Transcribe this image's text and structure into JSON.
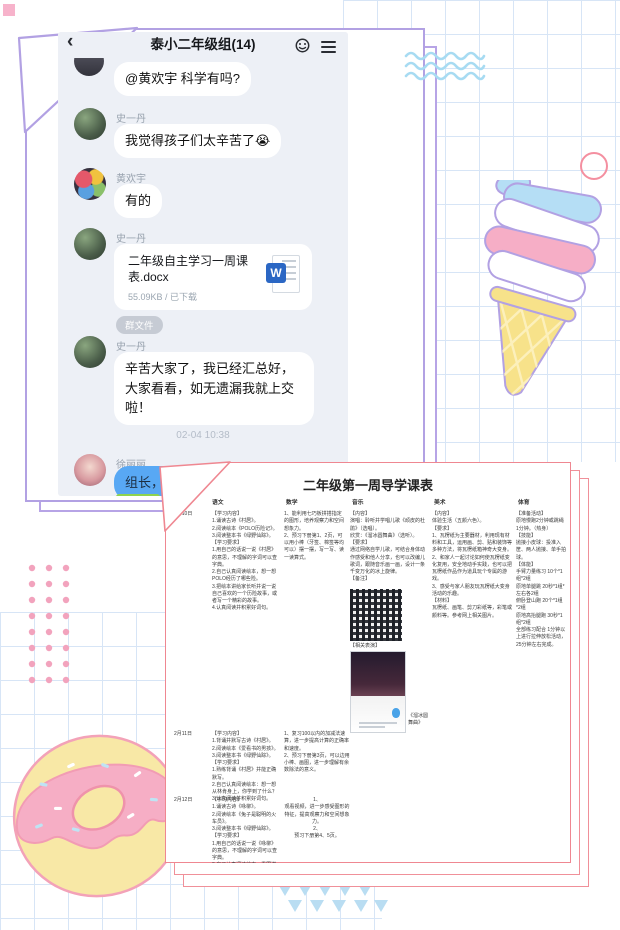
{
  "colors": {
    "frame_purple": "#b2a1e3",
    "doc_border_pink": "#ef8791",
    "grid_blue": "#d7e5f6",
    "chat_bg": "#edf0f6",
    "blue_bubble": "#58a8f4",
    "donut_pink": "#f6aec5",
    "cone_yellow": "#f7e28a"
  },
  "chat": {
    "back": "‹",
    "title": "泰小二年级组(14)",
    "icons": {
      "emoji": "emoji-smiley",
      "menu": "hamburger-menu"
    },
    "messages": {
      "m1": {
        "text": "@黄欢宇 科学有吗?"
      },
      "m2": {
        "name": "史一丹",
        "text": "我觉得孩子们太辛苦了😭"
      },
      "m3": {
        "name": "黄欢宇",
        "text": "有的"
      },
      "m4": {
        "name": "史一丹",
        "file_title": "二年级自主学习一周课表.docx",
        "file_meta": "55.09KB / 已下载",
        "word_letter": "W"
      },
      "chip": "群文件",
      "m5": {
        "name": "史一丹",
        "text": "辛苦大家了，我已经汇总好，大家看看，如无遗漏我就上交啦！"
      },
      "time": "02-04 10:38",
      "m6": {
        "name": "徐丽丽",
        "text": "组长，以"
      }
    }
  },
  "doc": {
    "title": "二年级第一周导学课表",
    "headers": {
      "chinese": "语文",
      "math": "数学",
      "music": "音乐",
      "art": "美术",
      "pe": "体育"
    },
    "rows": {
      "r1": {
        "date": "2月10日",
        "chinese": "【学习内容】\n1.诵读古诗《村居》。\n2.阅读绘本《POLO历险记》。\n3.阅读整本书《绿野仙踪》。\n【学习要求】\n1.用自己的话说一说《村居》的意思，不理解的字词可以查字典。\n2.自己认真阅读绘本，想一想POLO经历了哪些险。\n3.把绘本讲给家长听并说一说自己喜欢的一个历险故事，或者写一个精彩的故事。\n4.认真阅读并积累好词句。",
        "math": "1、能利用七巧板拼搭指定的图形，培养观察力和空间想象力。\n2、预习下册第1、2页，可以用小棒（牙签、棉签等均可以）摆一摆，写一写、读一读算式。",
        "music_top": "【内容】\n演唱：聆听并学唱儿歌《顽皮的杜鹃》（选唱）。\n欣赏：《溜冰圆舞曲》（选听）。\n【要求】\n通过网络自学儿歌，可结合身体动作感受和他人分享，也可以改编儿歌词，跟随音乐画一画，设计一条千变万化的冰上旋律。\n【备注】",
        "music_mid": "【相关表演】",
        "music_caption": "《溜冰圆舞曲》",
        "art": "【内容】\n体验生活（五颜六色）。\n【要求】\n1、瓦楞纸为主要器材，利用现有材料和工具，运用画、剪、贴和装饰等多种方法，将瓦楞纸箱神奇大变身。\n2、和家人一起讨论如何使瓦楞纸变化复用，安全地动手实践，也可以把瓦楞纸作品作为道具玩个专属的游戏。\n3、感受与家人朋友玩瓦楞纸大变身活动的乐趣。\n【材料】\n瓦楞纸、画笔、剪刀彩纸等，彩笔或颜料等。参考网上相关图片。",
        "pe": "【准备活动】\n原地慢跑2分钟或跳绳1分钟。（热身）\n【技能】\n抛接小皮球：投准入筐、两人抛接、单手拍球。\n【体能】\n手臂力量练习 10个*1组*2组\n原地单腿跳 20秒*1组*左右各2组\n俯卧登山跑 20个*1组*2组\n原地高抬腿跑 30秒*1组*2组\n全部练习配合 1分钟以上进行拉伸放松活动，25分钟左右完成。"
      },
      "r2": {
        "date": "2月11日",
        "chinese": "【学习内容】\n1.背诵并默写古诗《村居》。\n2.阅读绘本《爱看书的男孩》。\n3.阅读整本书《绿野仙踪》。\n【学习要求】\n1.熟练背诵《村居》并能正确默写。\n2.自己认真阅读绘本：想一想从林肯身上，你学到了什么？\n3.认真阅读并积累好词句。",
        "math": "1、复习100以内的加减法速算，进一步提高计算的正确率和速度。\n2、预习下册第3页，可以边用小棒、画图，进一步理解有余数除法的意义。"
      },
      "r3": {
        "date": "2月12日",
        "chinese": "【学习内容】\n1.诵读古诗《咏柳》。\n2.阅读绘本《兔子是聪明的火车员》。\n3.阅读整本书《绿野仙踪》。\n【学习要求】\n1.用自己的话说一说《咏柳》的意思，不理解的字词可以查字典。\n2.自己认真阅读绘本，看图讲一讲故事。",
        "math": "1、\n观看视频，进一步感受图形的特征，提高观察力和空间想象力。\n2、\n预习下册第4、5页。"
      }
    }
  }
}
